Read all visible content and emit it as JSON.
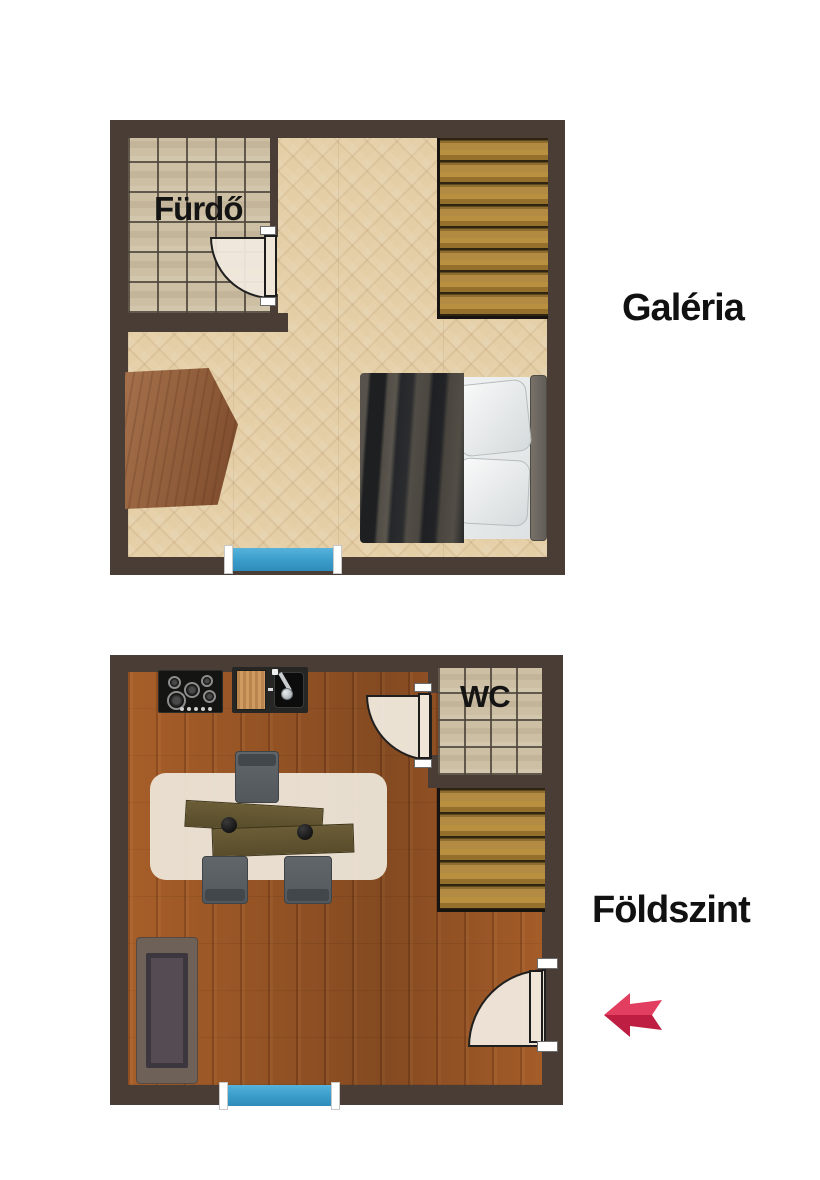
{
  "title": "Two-level apartment floor plan",
  "floors": [
    {
      "id": "galeria",
      "label": "Galéria",
      "floor_type": "light-herringbone-parquet",
      "rooms": [
        {
          "id": "furdo",
          "label": "Fürdő",
          "floor_type": "beige-tile"
        }
      ],
      "furniture": [
        "wooden-table",
        "double-bed",
        "staircase",
        "bathroom-door",
        "window"
      ]
    },
    {
      "id": "foldszint",
      "label": "Földszint",
      "floor_type": "dark-wood-plank",
      "rooms": [
        {
          "id": "wc",
          "label": "WC",
          "floor_type": "beige-tile"
        }
      ],
      "furniture": [
        "gas-hob",
        "cutting-board",
        "kitchen-sink",
        "office-desks",
        "office-chairs",
        "rug",
        "sofa",
        "staircase",
        "wc-door",
        "entry-door",
        "window"
      ]
    }
  ],
  "entry_arrow": {
    "direction": "left",
    "color_top": "#e13e60",
    "color_bottom": "#bd1e41"
  },
  "colors": {
    "background": "#ffffff",
    "wall": "#4a3d35",
    "light_floor": "#e4cea6",
    "dark_floor": "#9d5827",
    "tile": "#cdbfa3",
    "stairs": "#a8813c",
    "window_blue": "#3a9cca",
    "door_fill": "#efe6d8",
    "label_text": "#111111"
  }
}
